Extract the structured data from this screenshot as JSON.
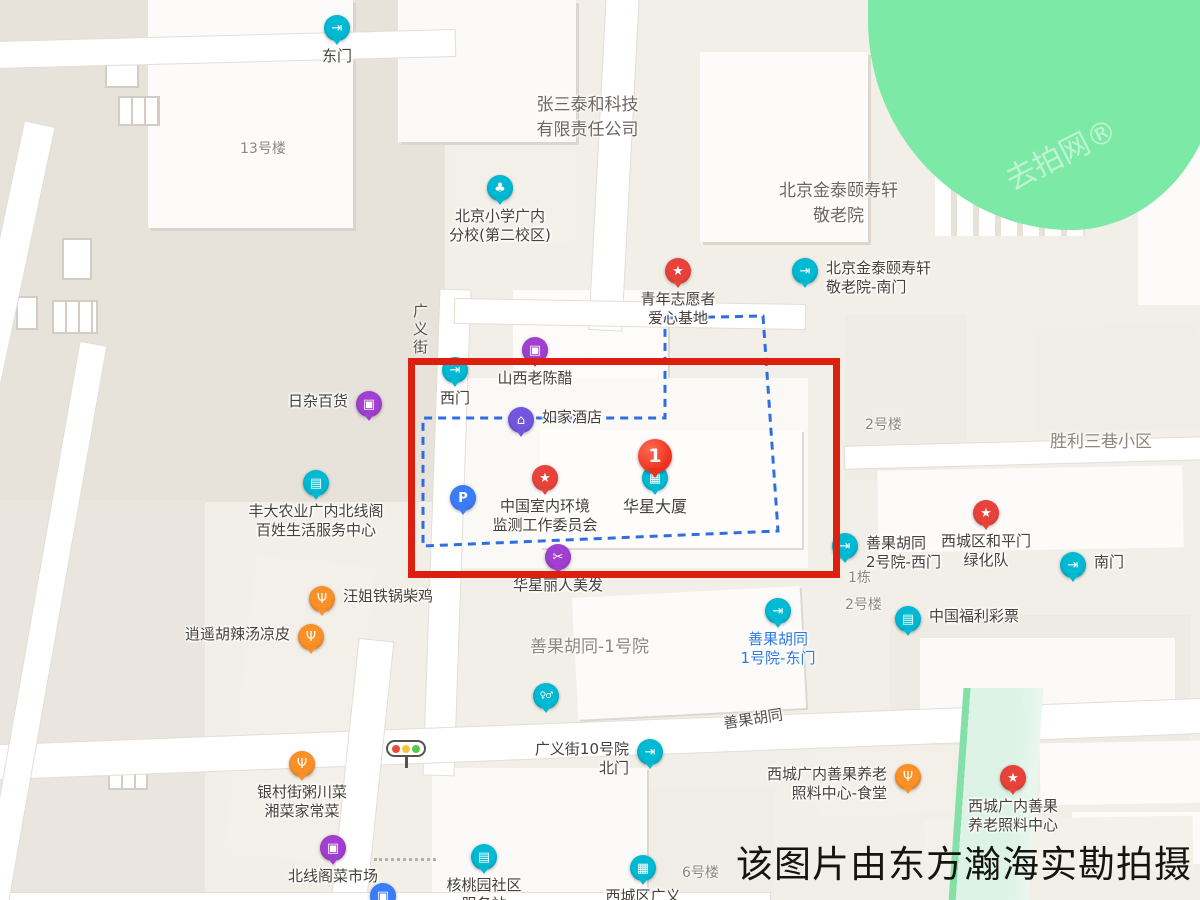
{
  "watermark": {
    "photo_credit": "该图片由东方瀚海实勘拍摄",
    "faint_repeat": "去拍网®"
  },
  "marker": {
    "number": "1"
  },
  "colors": {
    "highlight_red": "#dd1f0f",
    "selection_blue": "#2f6de0",
    "pin_teal": "#00b9d3",
    "pin_purple": "#a03fd0",
    "pin_indigo": "#7356de",
    "pin_red": "#e8433a",
    "pin_blue": "#3b7df8",
    "pin_orange": "#fb9027",
    "park_green": "#7de9a6"
  },
  "icons": {
    "gate": "⇥",
    "school": "♣",
    "bag": "▣",
    "bed": "⌂",
    "star": "★",
    "parking": "P",
    "building": "▦",
    "scissors": "✂",
    "store": "▤",
    "food": "Ψ",
    "toilet": "♀♂",
    "metro": "▣"
  },
  "streets": [
    {
      "name": "广义街"
    },
    {
      "name": "善果胡同"
    }
  ],
  "areas": [
    {
      "name": "13号楼"
    },
    {
      "name": "张三泰和科技\n有限责任公司"
    },
    {
      "name": "北京金泰颐寿轩\n敬老院"
    },
    {
      "name": "2号楼"
    },
    {
      "name": "胜利三巷小区"
    },
    {
      "name": "1栋"
    },
    {
      "name": "2号楼"
    },
    {
      "name": "善果胡同-1号院"
    },
    {
      "name": "6号楼"
    }
  ],
  "pois": [
    {
      "label": "东门",
      "type": "gate"
    },
    {
      "label": "北京小学广内\n分校(第二校区)",
      "type": "school"
    },
    {
      "label": "北京金泰颐寿轩\n敬老院-南门",
      "type": "gate"
    },
    {
      "label": "青年志愿者\n爱心基地",
      "type": "star"
    },
    {
      "label": "西门",
      "type": "gate"
    },
    {
      "label": "山西老陈醋",
      "type": "shop"
    },
    {
      "label": "如家酒店",
      "type": "hotel"
    },
    {
      "label": "日杂百货",
      "type": "shop"
    },
    {
      "label": "丰大农业广内北线阁\n百姓生活服务中心",
      "type": "store"
    },
    {
      "label": "",
      "type": "parking"
    },
    {
      "label": "中国室内环境\n监测工作委员会",
      "type": "star"
    },
    {
      "label": "华星大厦",
      "type": "building"
    },
    {
      "label": "华星丽人美发",
      "type": "salon"
    },
    {
      "label": "善果胡同\n2号院-西门",
      "type": "gate"
    },
    {
      "label": "西城区和平门\n绿化队",
      "type": "star"
    },
    {
      "label": "南门",
      "type": "gate"
    },
    {
      "label": "中国福利彩票",
      "type": "store"
    },
    {
      "label": "汪姐铁锅柴鸡",
      "type": "food"
    },
    {
      "label": "逍遥胡辣汤凉皮",
      "type": "food"
    },
    {
      "label": "善果胡同\n1号院-东门",
      "type": "gate"
    },
    {
      "label": "",
      "type": "toilet"
    },
    {
      "label": "广义街10号院\n北门",
      "type": "gate"
    },
    {
      "label": "西城广内善果养老\n照料中心-食堂",
      "type": "food"
    },
    {
      "label": "西城广内善果\n养老照料中心",
      "type": "star"
    },
    {
      "label": "银村街粥川菜\n湘菜家常菜",
      "type": "food"
    },
    {
      "label": "北线阁菜市场",
      "type": "shop"
    },
    {
      "label": "核桃园社区\n服务站",
      "type": "store"
    },
    {
      "label": "西城区广义",
      "type": "building"
    },
    {
      "label": "",
      "type": "metro"
    }
  ]
}
